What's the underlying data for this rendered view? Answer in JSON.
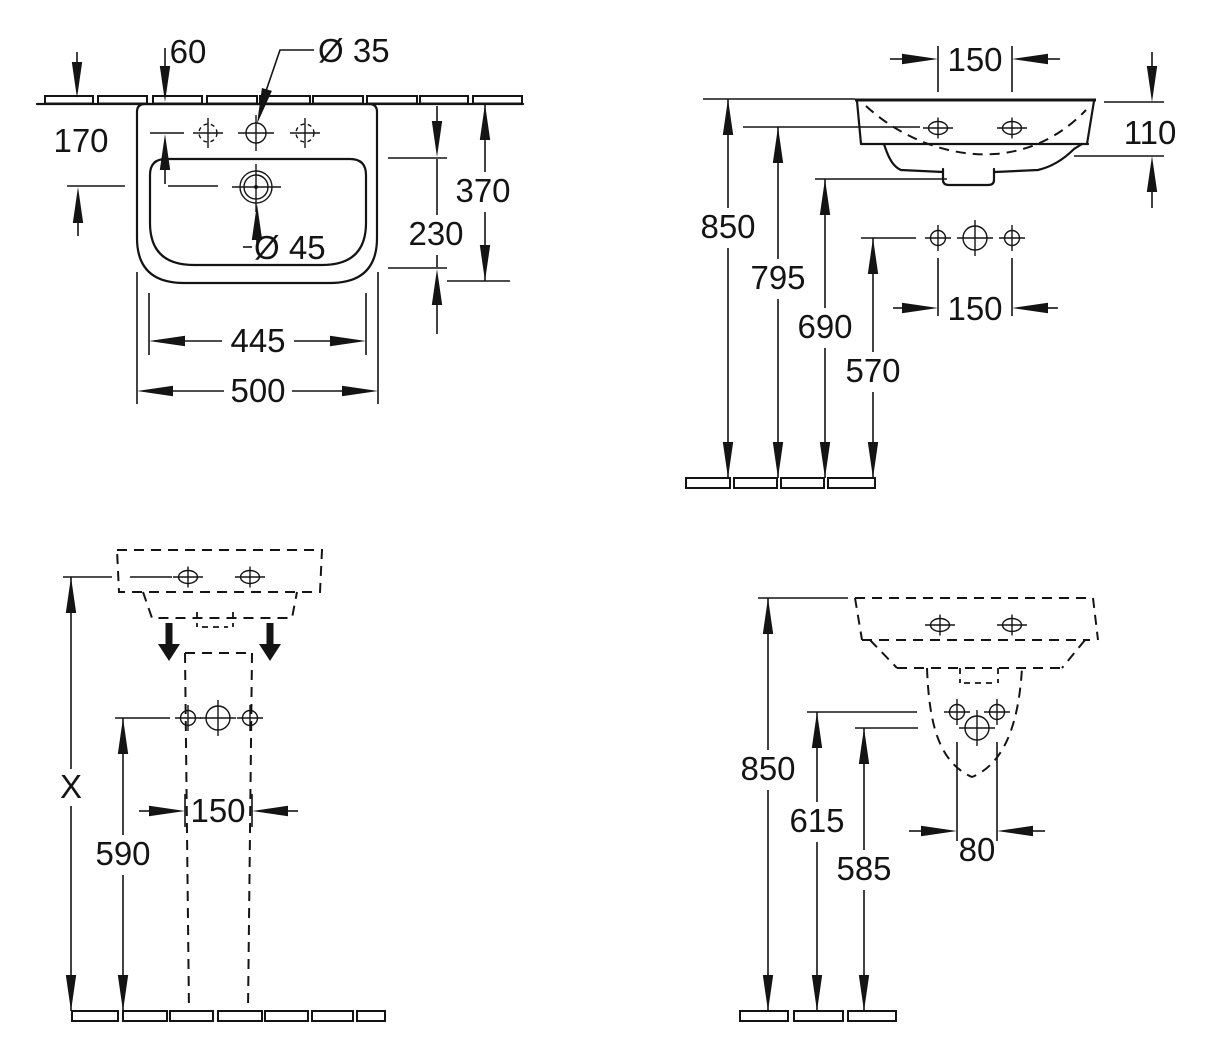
{
  "title": "Washbasin with pedestal — technical dimension drawing (4 orthographic views)",
  "units": "mm",
  "style": {
    "line_color": "#141414",
    "background": "#ffffff"
  },
  "views": {
    "plan": {
      "name": "Top view (plan) of washbasin against wall",
      "dims": {
        "wall_to_tap_hole": "60",
        "tap_hole_dia": "Ø 35",
        "wall_to_drain": "170",
        "overall_depth": "370",
        "bowl_depth": "230",
        "drain_dia": "Ø 45",
        "bowl_width": "445",
        "overall_width": "500"
      }
    },
    "side": {
      "name": "Side elevation, wall-hung basin",
      "dims": {
        "tap_spacing_top": "150",
        "rim_band_height": "110",
        "rim_to_floor": "850",
        "underside_to_floor": "795",
        "apron_to_floor": "690",
        "supply_to_floor": "570",
        "supply_spacing": "150"
      }
    },
    "front_pedestal": {
      "name": "Front view with pedestal",
      "dims": {
        "rim_to_floor": "X",
        "supply_to_floor": "590",
        "pedestal_width": "150"
      }
    },
    "side_pedestal": {
      "name": "Side view with pedestal / outlet",
      "dims": {
        "rim_to_floor": "850",
        "supply_to_floor": "615",
        "outlet_to_floor": "585",
        "outlet_width": "80"
      }
    }
  }
}
